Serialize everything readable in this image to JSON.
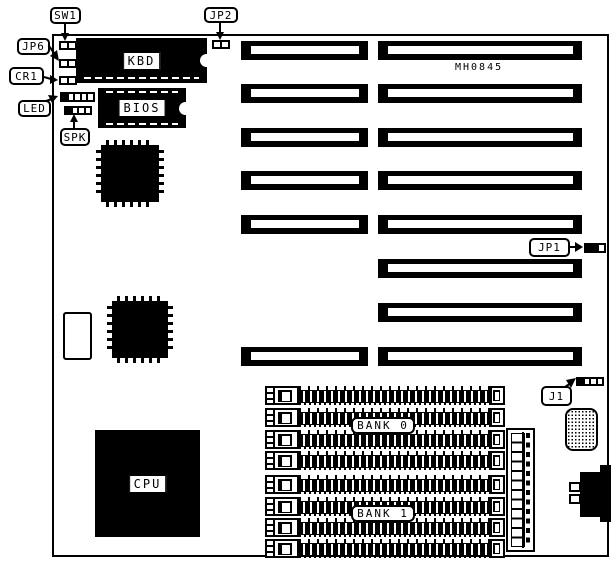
{
  "colors": {
    "ink": "#000000",
    "background": "#ffffff"
  },
  "board": {
    "model_text": "MH0845"
  },
  "callouts": {
    "sw1": {
      "label": "SW1"
    },
    "jp6": {
      "label": "JP6"
    },
    "cr1": {
      "label": "CR1"
    },
    "led": {
      "label": "LED"
    },
    "spk": {
      "label": "SPK"
    },
    "jp2": {
      "label": "JP2"
    },
    "jp1": {
      "label": "JP1"
    },
    "j1": {
      "label": "J1"
    }
  },
  "chips": {
    "kbd": {
      "label": "KBD"
    },
    "bios": {
      "label": "BIOS"
    },
    "cpu": {
      "label": "CPU"
    }
  },
  "memory": {
    "bank0": {
      "label": "BANK 0"
    },
    "bank1": {
      "label": "BANK 1"
    }
  }
}
